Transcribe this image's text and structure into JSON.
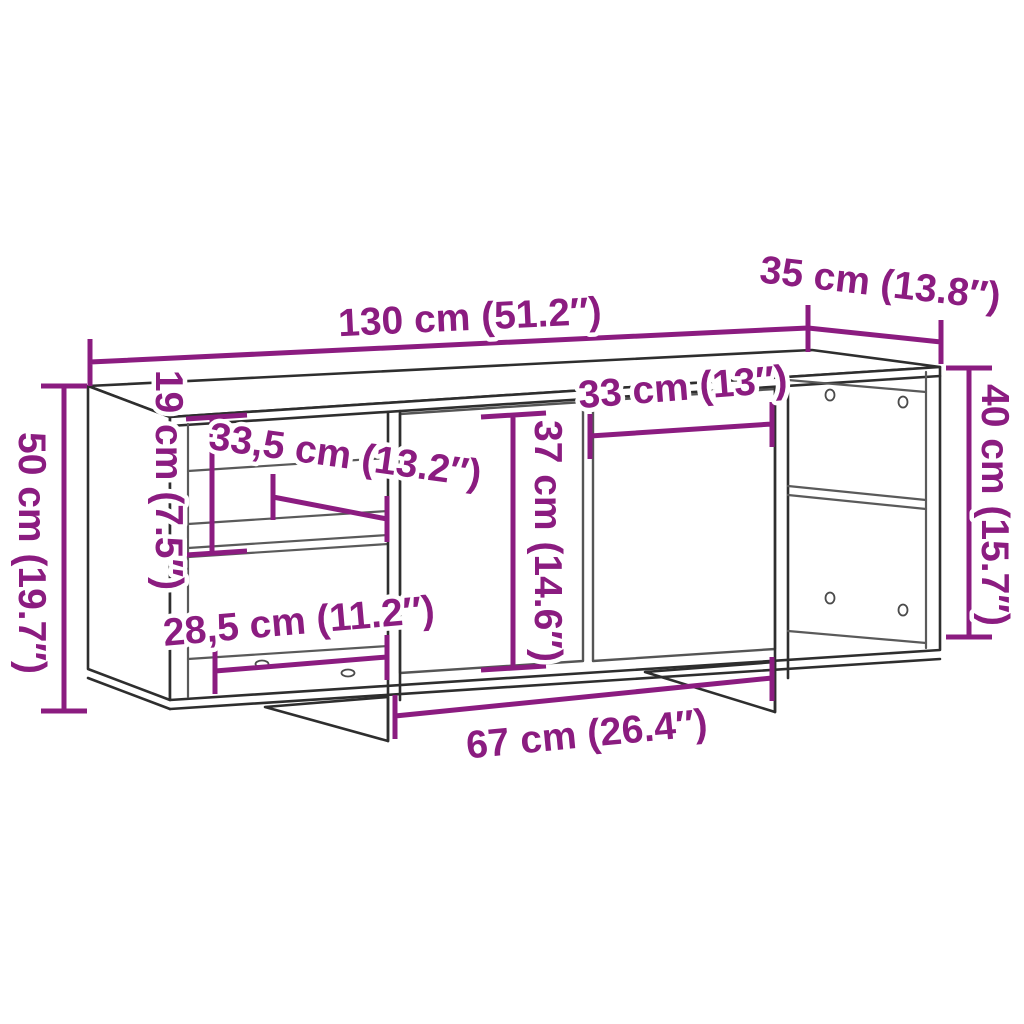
{
  "diagram": {
    "kind": "furniture-dimension-diagram",
    "subject": "wall-mounted TV cabinet line drawing with open side compartments and two center doors",
    "colors": {
      "background": "#ffffff",
      "dimension_accent": "#8b1c80",
      "outline": "#2e2e2e",
      "interior_lines": "#5a5a5a"
    },
    "dimensions": [
      {
        "id": "total-width",
        "label": "130 cm (51.2″)"
      },
      {
        "id": "depth",
        "label": "35 cm (13.8″)"
      },
      {
        "id": "right-section-height",
        "label": "40 cm (15.7″)"
      },
      {
        "id": "total-height",
        "label": "50 cm (19.7″)"
      },
      {
        "id": "left-top-compartment-height",
        "label": "19 cm (7.5″)"
      },
      {
        "id": "left-inner-width",
        "label": "33,5 cm (13.2″)"
      },
      {
        "id": "door-height",
        "label": "37 cm (14.6″)"
      },
      {
        "id": "door-width",
        "label": "33 cm (13″)"
      },
      {
        "id": "left-bottom-compartment-width",
        "label": "28,5 cm (11.2″)"
      },
      {
        "id": "center-section-width",
        "label": "67 cm (26.4″)"
      }
    ]
  }
}
